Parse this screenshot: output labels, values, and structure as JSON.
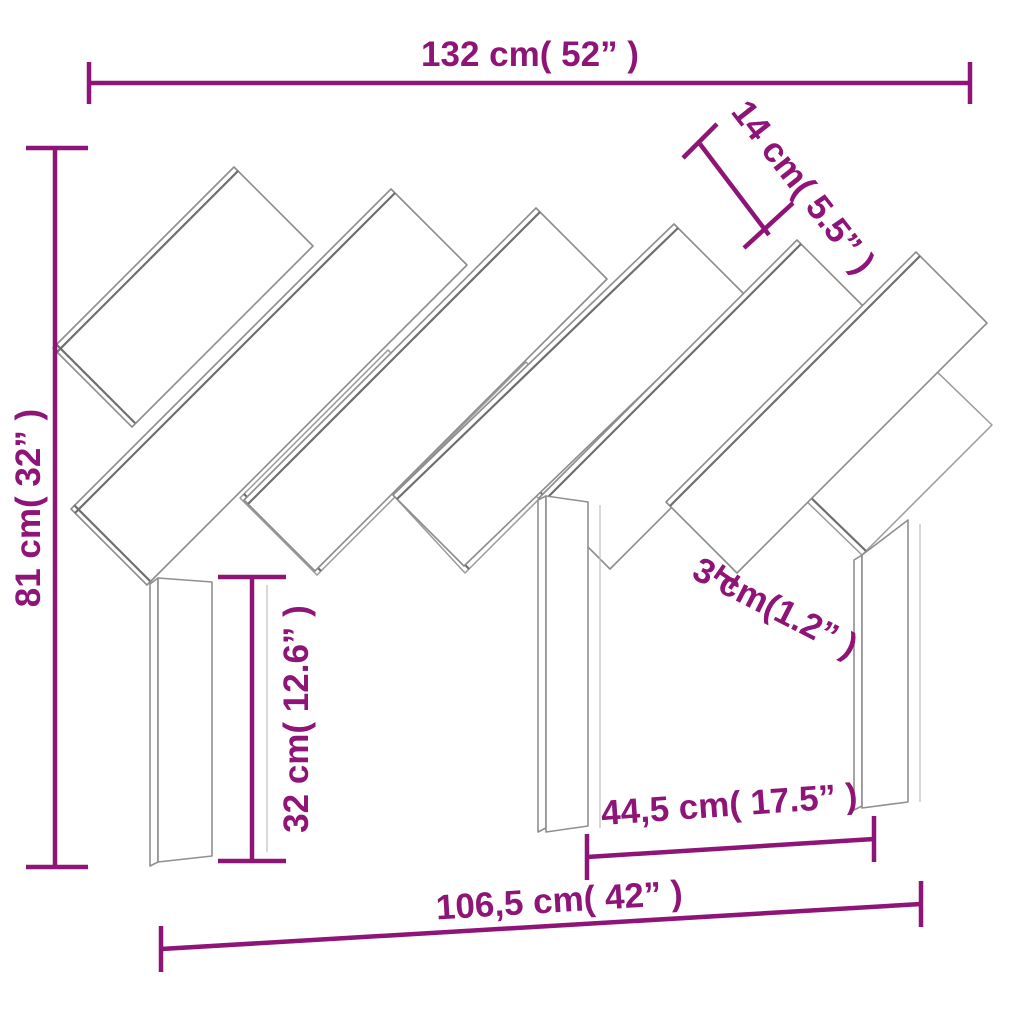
{
  "diagram": {
    "type": "furniture-dimension-drawing",
    "subject": "slatted wooden headboard with legs",
    "accent_color": "#8E1477",
    "outline_color": "#8c8c8c",
    "background_color": "#ffffff"
  },
  "labels": {
    "width_total": "132 cm( 52” )",
    "slat_width": "14 cm( 5.5” )",
    "height_total": "81 cm( 32” )",
    "leg_height": "32 cm( 12.6” )",
    "thickness": "3 cm(1.2” )",
    "legs_inner_span": "44,5 cm( 17.5” )",
    "legs_outer_span": "106,5 cm( 42” )"
  }
}
